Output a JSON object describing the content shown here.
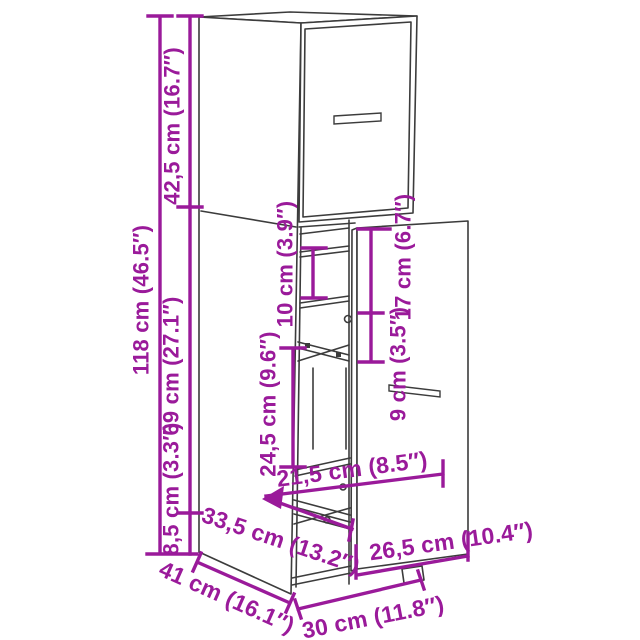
{
  "colors": {
    "accent": "#9A1A9A",
    "line": "#3C3C3C",
    "background": "#FFFFFF"
  },
  "diagram": {
    "labels": {
      "total_height": "118 cm (46.5″)",
      "upper_door_height": "42,5 cm (16.7″)",
      "lower_section_height": "69 cm (27.1″)",
      "plinth_height": "8,5 cm (3.3″)",
      "shelf_gap_height": "10 cm (3.9″)",
      "compartment_height": "24,5 cm (9.6″)",
      "drawer_top_to_handle": "17 cm (6.7″)",
      "handle_section_height": "9 cm (3.5″)",
      "inner_width": "21,5 cm (8.5″)",
      "inner_depth": "33,5 cm (13.2″)",
      "drawer_front_width": "26,5 cm (10.4″)",
      "cabinet_width": "30 cm (11.8″)",
      "cabinet_depth": "41 cm (16.1″)"
    }
  }
}
